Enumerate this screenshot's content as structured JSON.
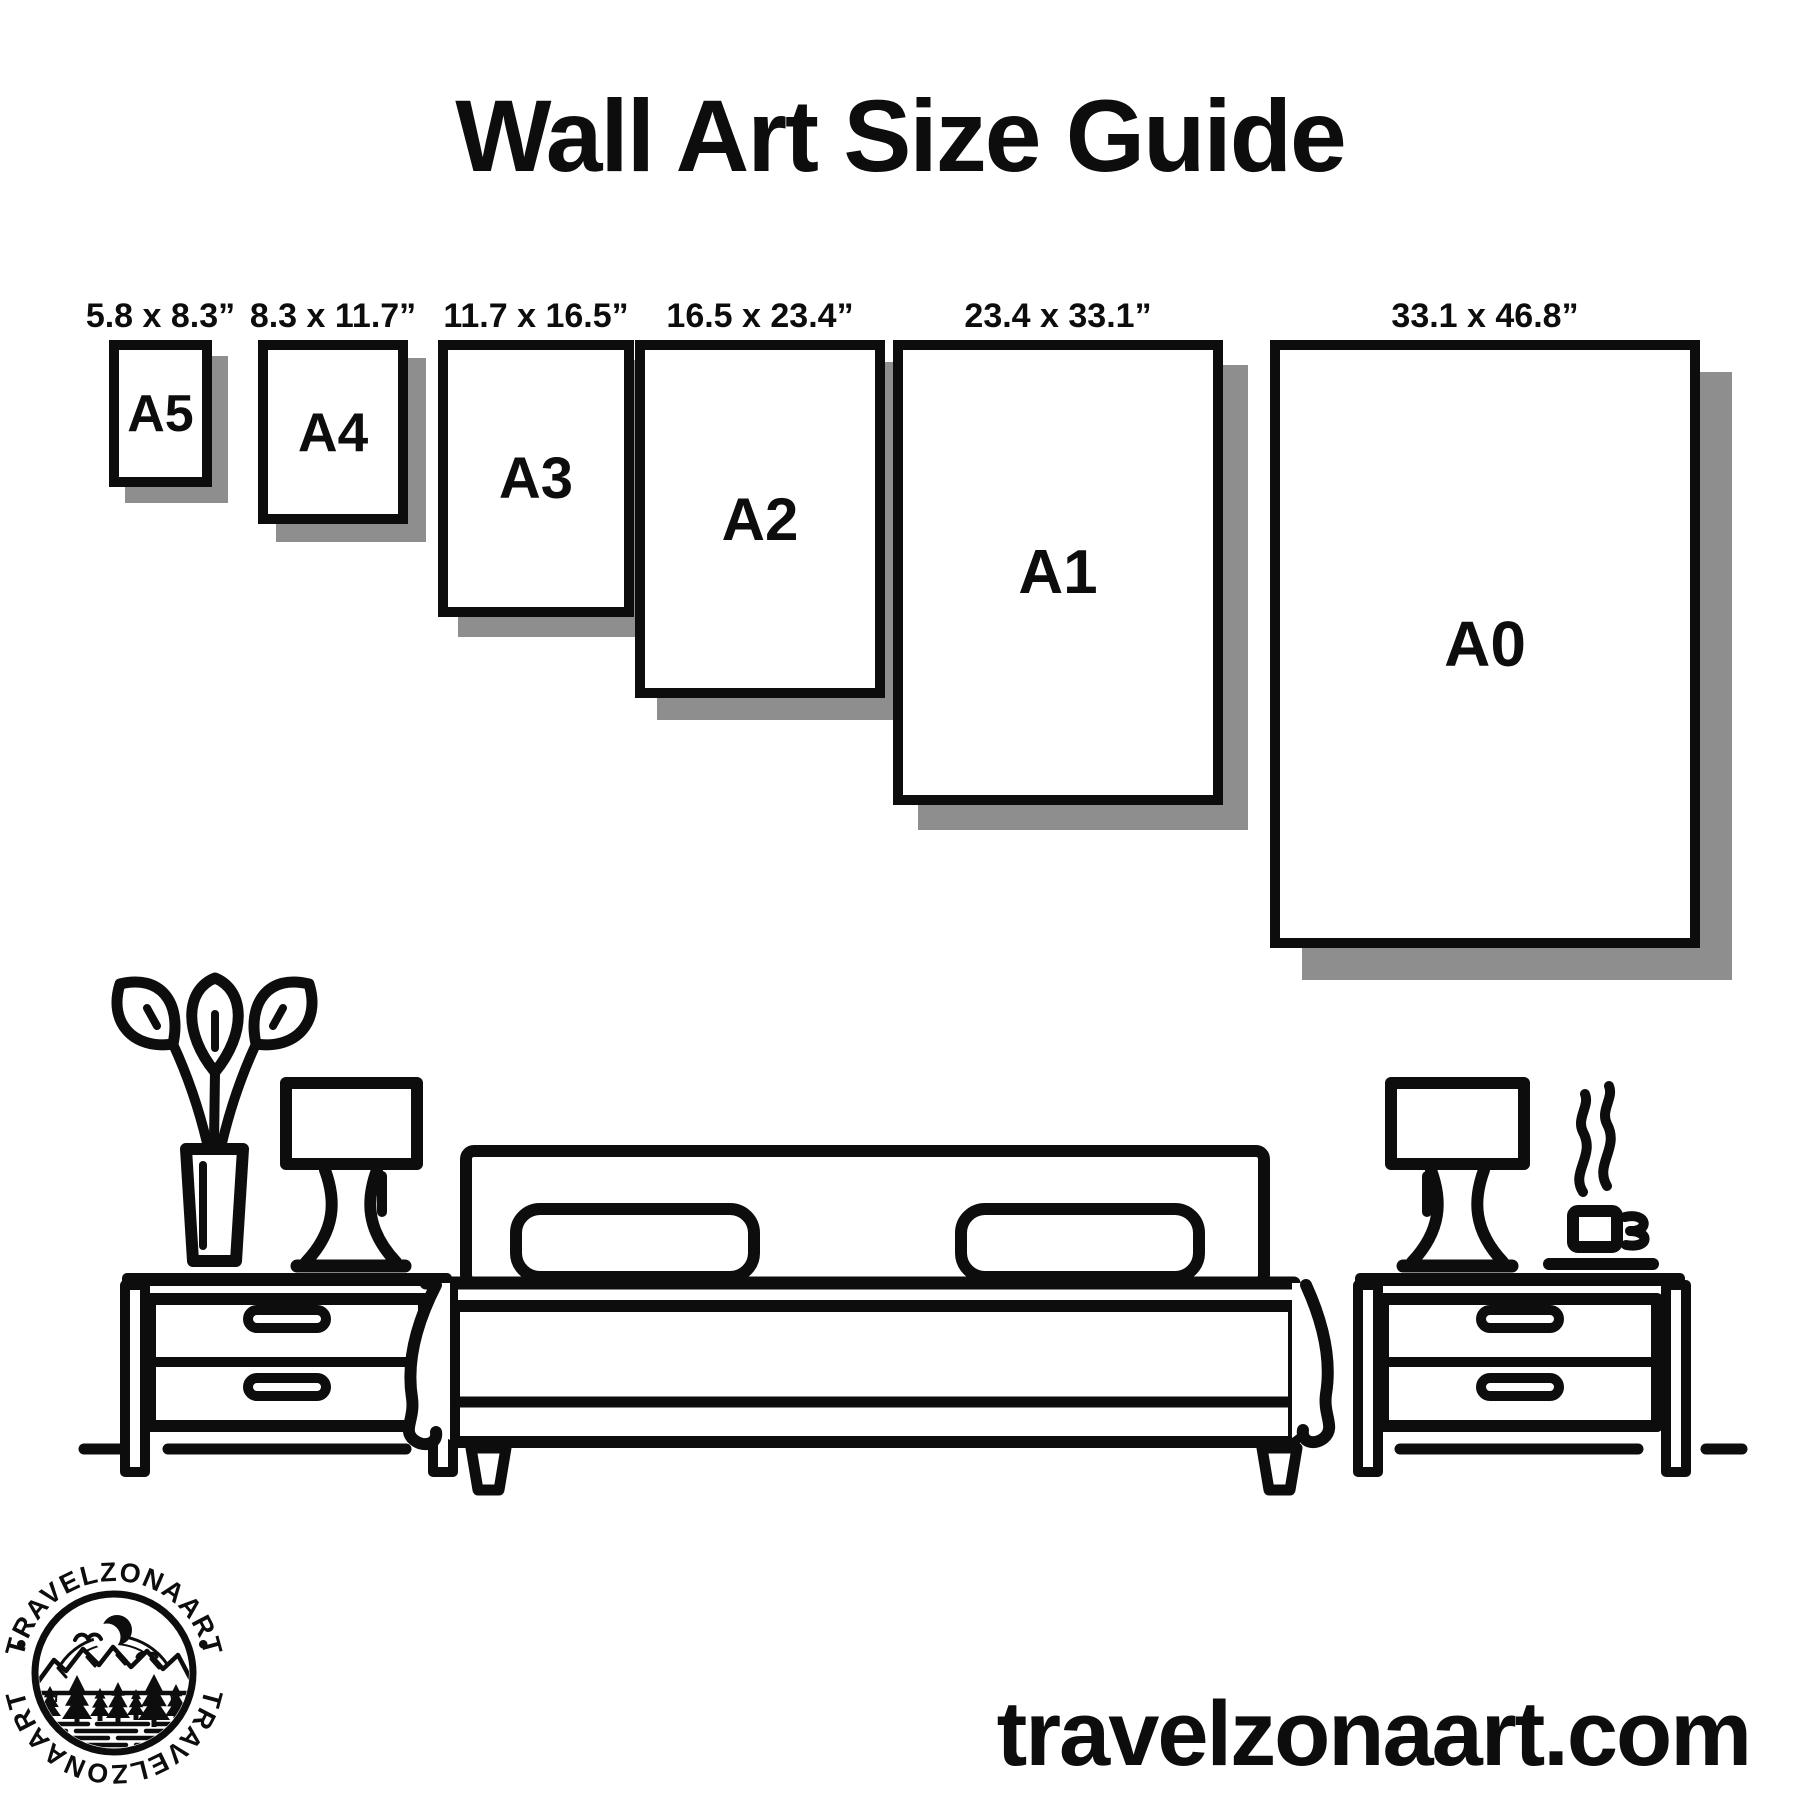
{
  "title": "Wall Art Size Guide",
  "website_label": "travelzonaart.com",
  "logo": {
    "brand_top": "TRAVELZONAART",
    "brand_bottom": "TRAVELZONAART",
    "separator": "•"
  },
  "frames_section": {
    "frame_top": 340,
    "sizes": [
      {
        "code": "A5",
        "dimensions": "5.8 x 8.3”",
        "left": 109,
        "width": 103,
        "height": 147,
        "code_font": 52,
        "shadow": 16
      },
      {
        "code": "A4",
        "dimensions": "8.3 x 11.7”",
        "left": 258,
        "width": 150,
        "height": 184,
        "code_font": 55,
        "shadow": 18
      },
      {
        "code": "A3",
        "dimensions": "11.7 x 16.5”",
        "left": 438,
        "width": 196,
        "height": 277,
        "code_font": 58,
        "shadow": 20
      },
      {
        "code": "A2",
        "dimensions": "16.5 x 23.4”",
        "left": 635,
        "width": 250,
        "height": 358,
        "code_font": 60,
        "shadow": 22
      },
      {
        "code": "A1",
        "dimensions": "23.4 x 33.1”",
        "left": 893,
        "width": 330,
        "height": 465,
        "code_font": 62,
        "shadow": 25
      },
      {
        "code": "A0",
        "dimensions": "33.1 x 46.8”",
        "left": 1270,
        "width": 430,
        "height": 608,
        "code_font": 64,
        "shadow": 32
      }
    ]
  },
  "colors": {
    "ink": "#0d0d0d",
    "shadow": "#8e8e8e",
    "background": "#ffffff"
  }
}
